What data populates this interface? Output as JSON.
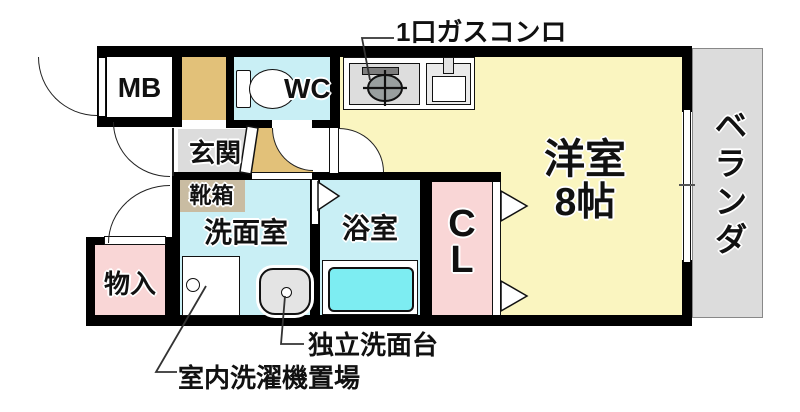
{
  "title": "apartment-floor-plan",
  "colors": {
    "wall": "#000000",
    "line": "#222222",
    "room_yellow": "#faf5c0",
    "room_cyan": "#c9eff5",
    "tub_cyan": "#7dedf2",
    "room_pink": "#f9d6d6",
    "tan": "#e2c179",
    "shoebox": "#c9bca2",
    "gray": "#dcdcdc",
    "fixture_gray": "#dddddd"
  },
  "labels": {
    "mb": "MB",
    "wc": "WC",
    "entrance": "玄関",
    "shoe_box": "靴箱",
    "washroom": "洗面室",
    "bathroom": "浴室",
    "closet_line1": "C",
    "closet_line2": "L",
    "western_room": "洋室",
    "western_room_size": "8帖",
    "veranda": "ベランダ",
    "storage": "物入"
  },
  "annotations": {
    "gas_stove": "1口ガスコンロ",
    "washstand": "独立洗面台",
    "washer_space": "室内洗濯機置場"
  },
  "icons": {
    "toilet": "toilet-icon",
    "gas_burner": "gas-burner-icon",
    "kitchen_sink": "kitchen-sink-icon",
    "bathtub": "bathtub-icon",
    "washstand": "washstand-icon",
    "washing_machine_space": "washing-machine-space-icon",
    "door_swing": "door-swing-arc-icon",
    "sliding_door": "sliding-door-triangle-icon"
  }
}
